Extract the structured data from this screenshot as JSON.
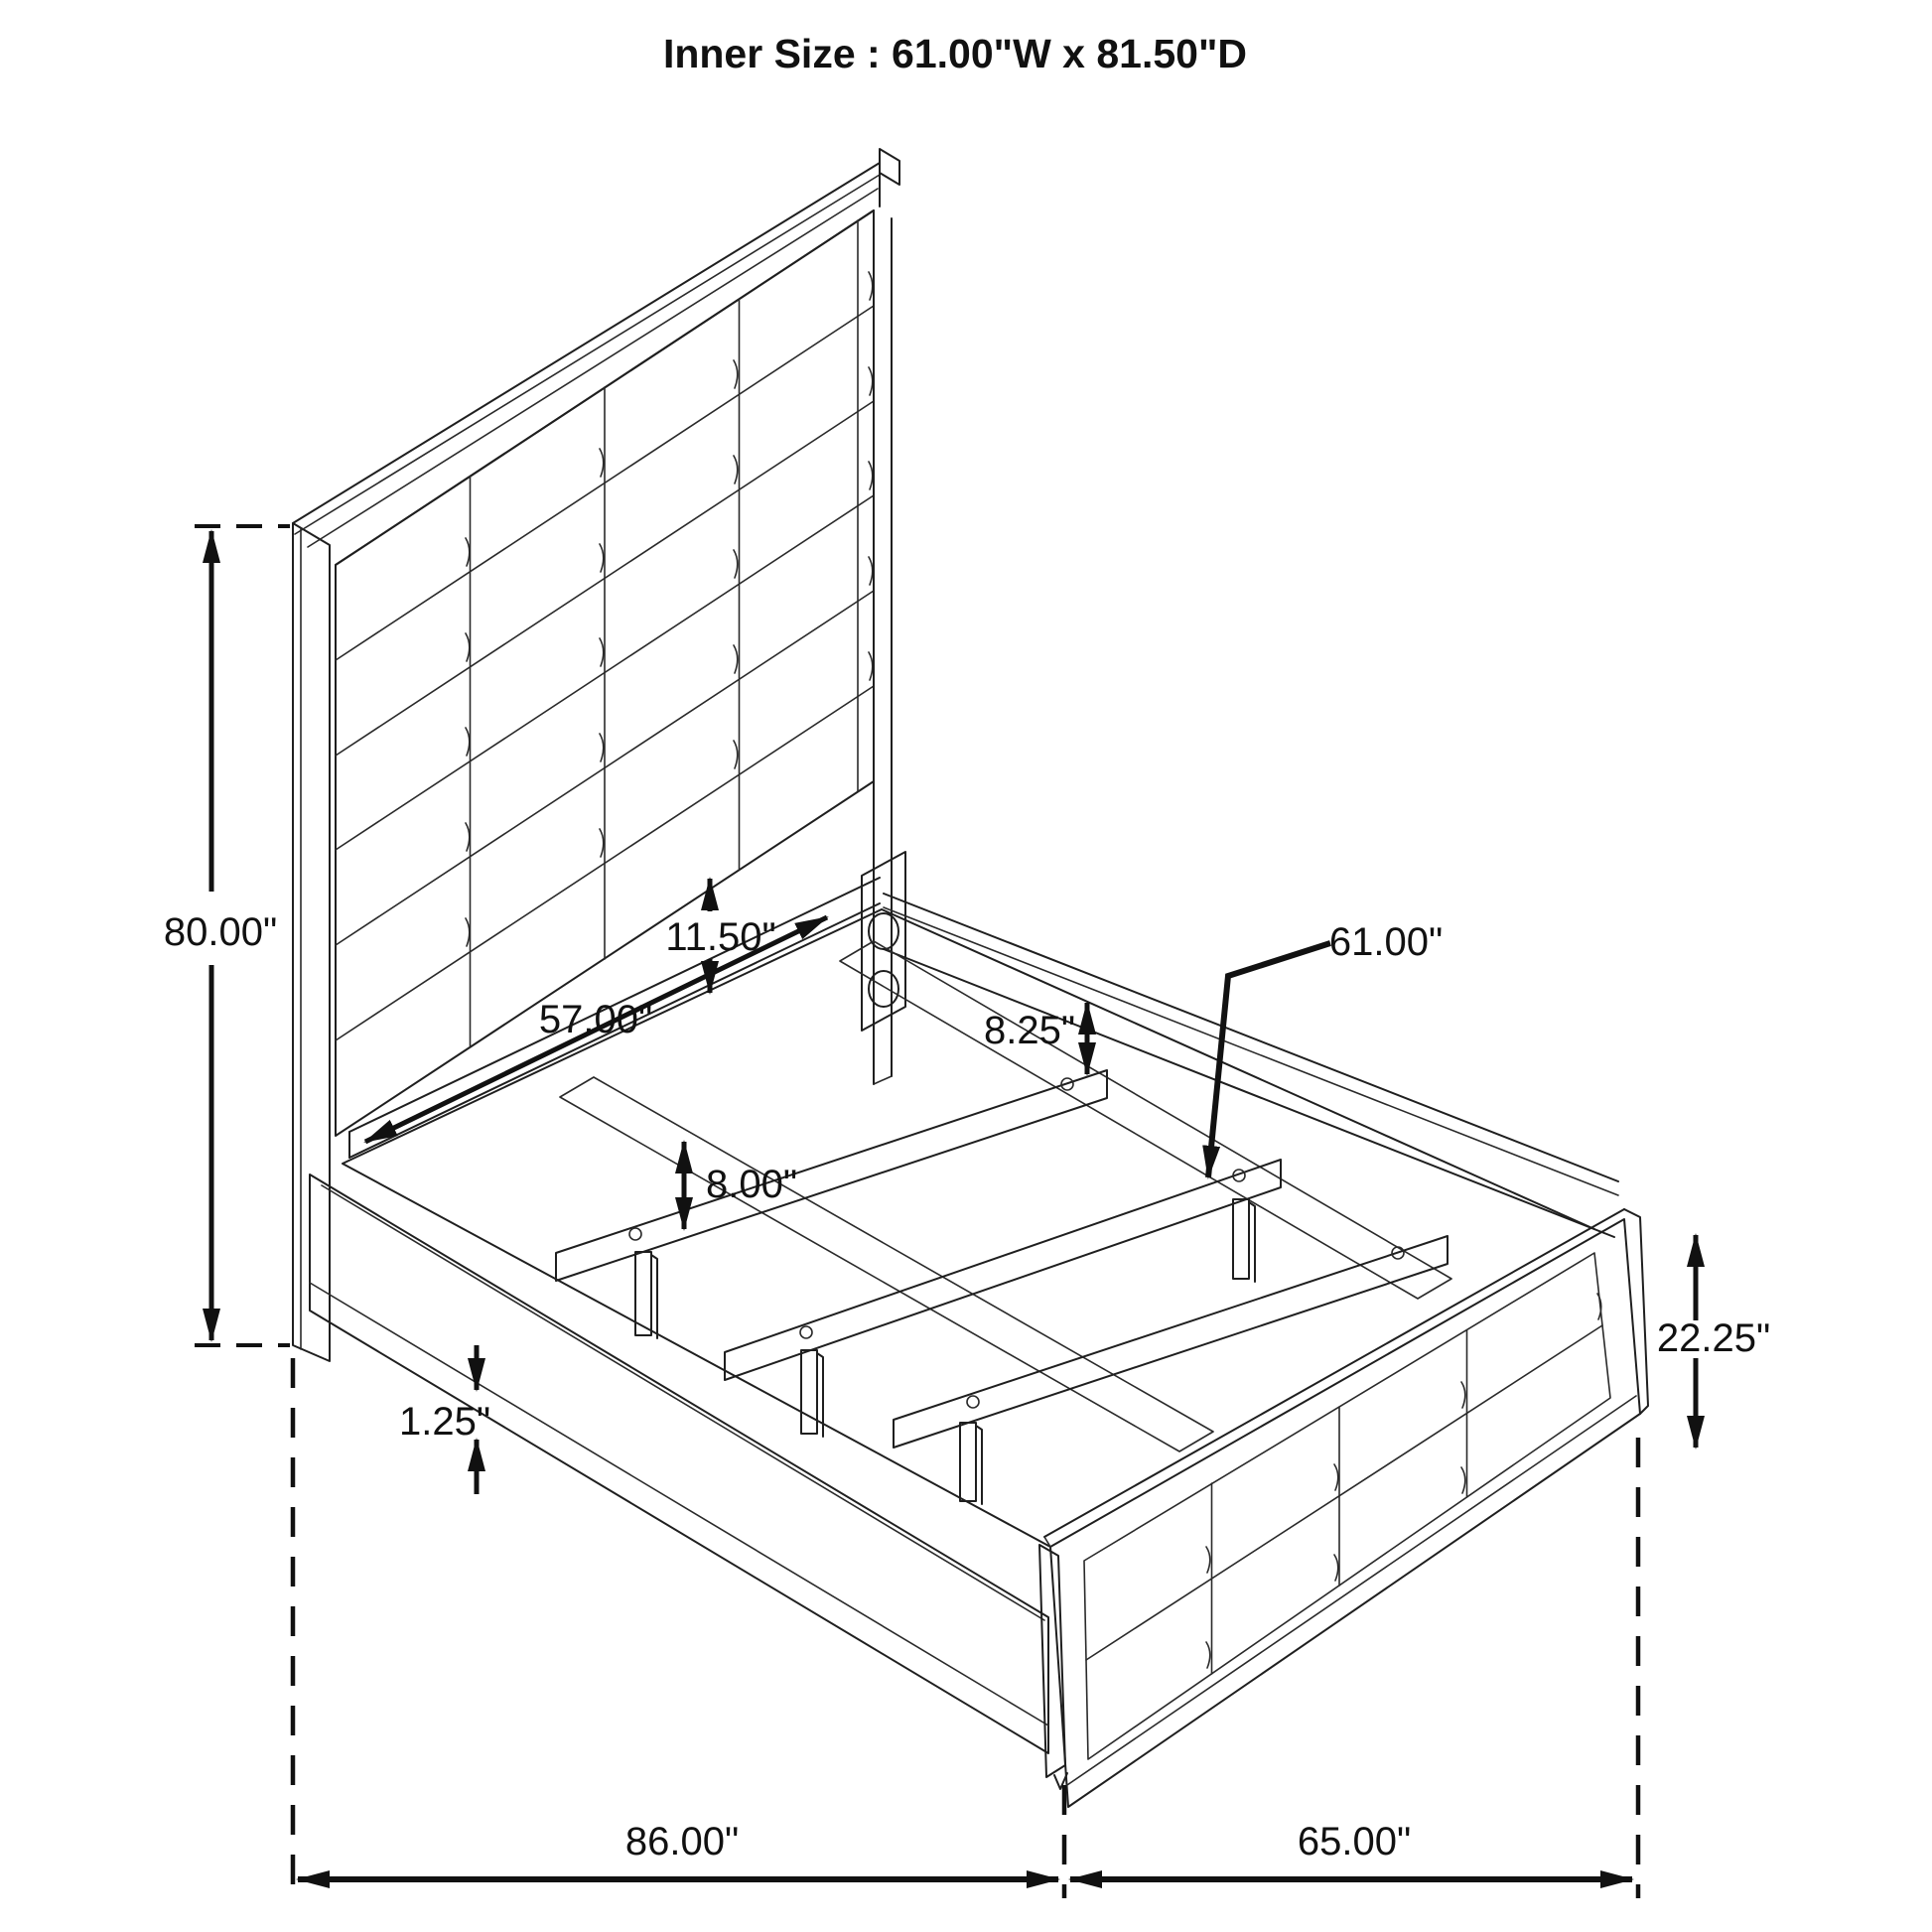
{
  "title": "Inner Size : 61.00\"W x 81.50\"D",
  "diagram": {
    "type": "isometric dimension drawing",
    "subject": "bed frame with channel-tufted headboard, slat platform, center support rails and paneled footboard",
    "line_color": "#1f1f1f",
    "dimension_color": "#111111",
    "background_color": "#ffffff",
    "headboard_grid": {
      "columns": 4,
      "rows": 6
    },
    "footboard_grid": {
      "columns": 4,
      "rows": 2
    }
  },
  "dimensions": {
    "headboard_height": {
      "label": "80.00\"",
      "measures": "overall headboard height"
    },
    "panel_gap": {
      "label": "11.50\"",
      "measures": "gap between upholstered panel bottom and head rail"
    },
    "head_rail_length": {
      "label": "57.00\"",
      "measures": "head mounting rail length"
    },
    "rail_to_slat_gap": {
      "label": "8.25\"",
      "measures": "distance from side rail to first slat"
    },
    "slat_length": {
      "label": "61.00\"",
      "measures": "inner slat width"
    },
    "support_leg_height": {
      "label": "8.00\"",
      "measures": "center support leg height"
    },
    "rail_trim": {
      "label": "1.25\"",
      "measures": "side rail bottom trim thickness"
    },
    "footboard_height": {
      "label": "22.25\"",
      "measures": "footboard height"
    },
    "overall_length": {
      "label": "86.00\"",
      "measures": "overall frame length"
    },
    "overall_width": {
      "label": "65.00\"",
      "measures": "overall frame width"
    }
  }
}
